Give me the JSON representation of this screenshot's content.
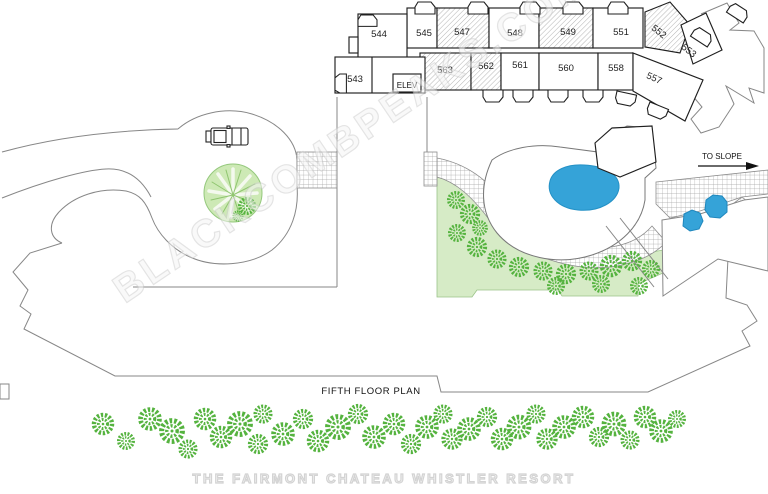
{
  "watermark": {
    "diagonal": "BLACKCOMBPEAKS.COM",
    "footer": "THE FAIRMONT CHATEAU WHISTLER RESORT"
  },
  "plan": {
    "title": "FIFTH FLOOR PLAN",
    "slope_label": "TO SLOPE",
    "elevator_label": "ELEV",
    "rooms": [
      {
        "number": "544",
        "hatched": false
      },
      {
        "number": "545",
        "hatched": false
      },
      {
        "number": "547",
        "hatched": true
      },
      {
        "number": "548",
        "hatched": false
      },
      {
        "number": "549",
        "hatched": true
      },
      {
        "number": "551",
        "hatched": false
      },
      {
        "number": "552",
        "hatched": true
      },
      {
        "number": "553",
        "hatched": false
      },
      {
        "number": "543",
        "hatched": false
      },
      {
        "number": "563",
        "hatched": true
      },
      {
        "number": "562",
        "hatched": true
      },
      {
        "number": "561",
        "hatched": false
      },
      {
        "number": "560",
        "hatched": false
      },
      {
        "number": "558",
        "hatched": false
      },
      {
        "number": "557",
        "hatched": false
      }
    ],
    "colors": {
      "pool_blue": "#35a3d8",
      "tree_green": "#55b33f",
      "lawn_green": "#d6ebc6",
      "island_green": "#cde9b5",
      "wall": "#1f1f1f",
      "outline_gray": "#878787",
      "hatch_gray": "#b3b3b3"
    }
  }
}
